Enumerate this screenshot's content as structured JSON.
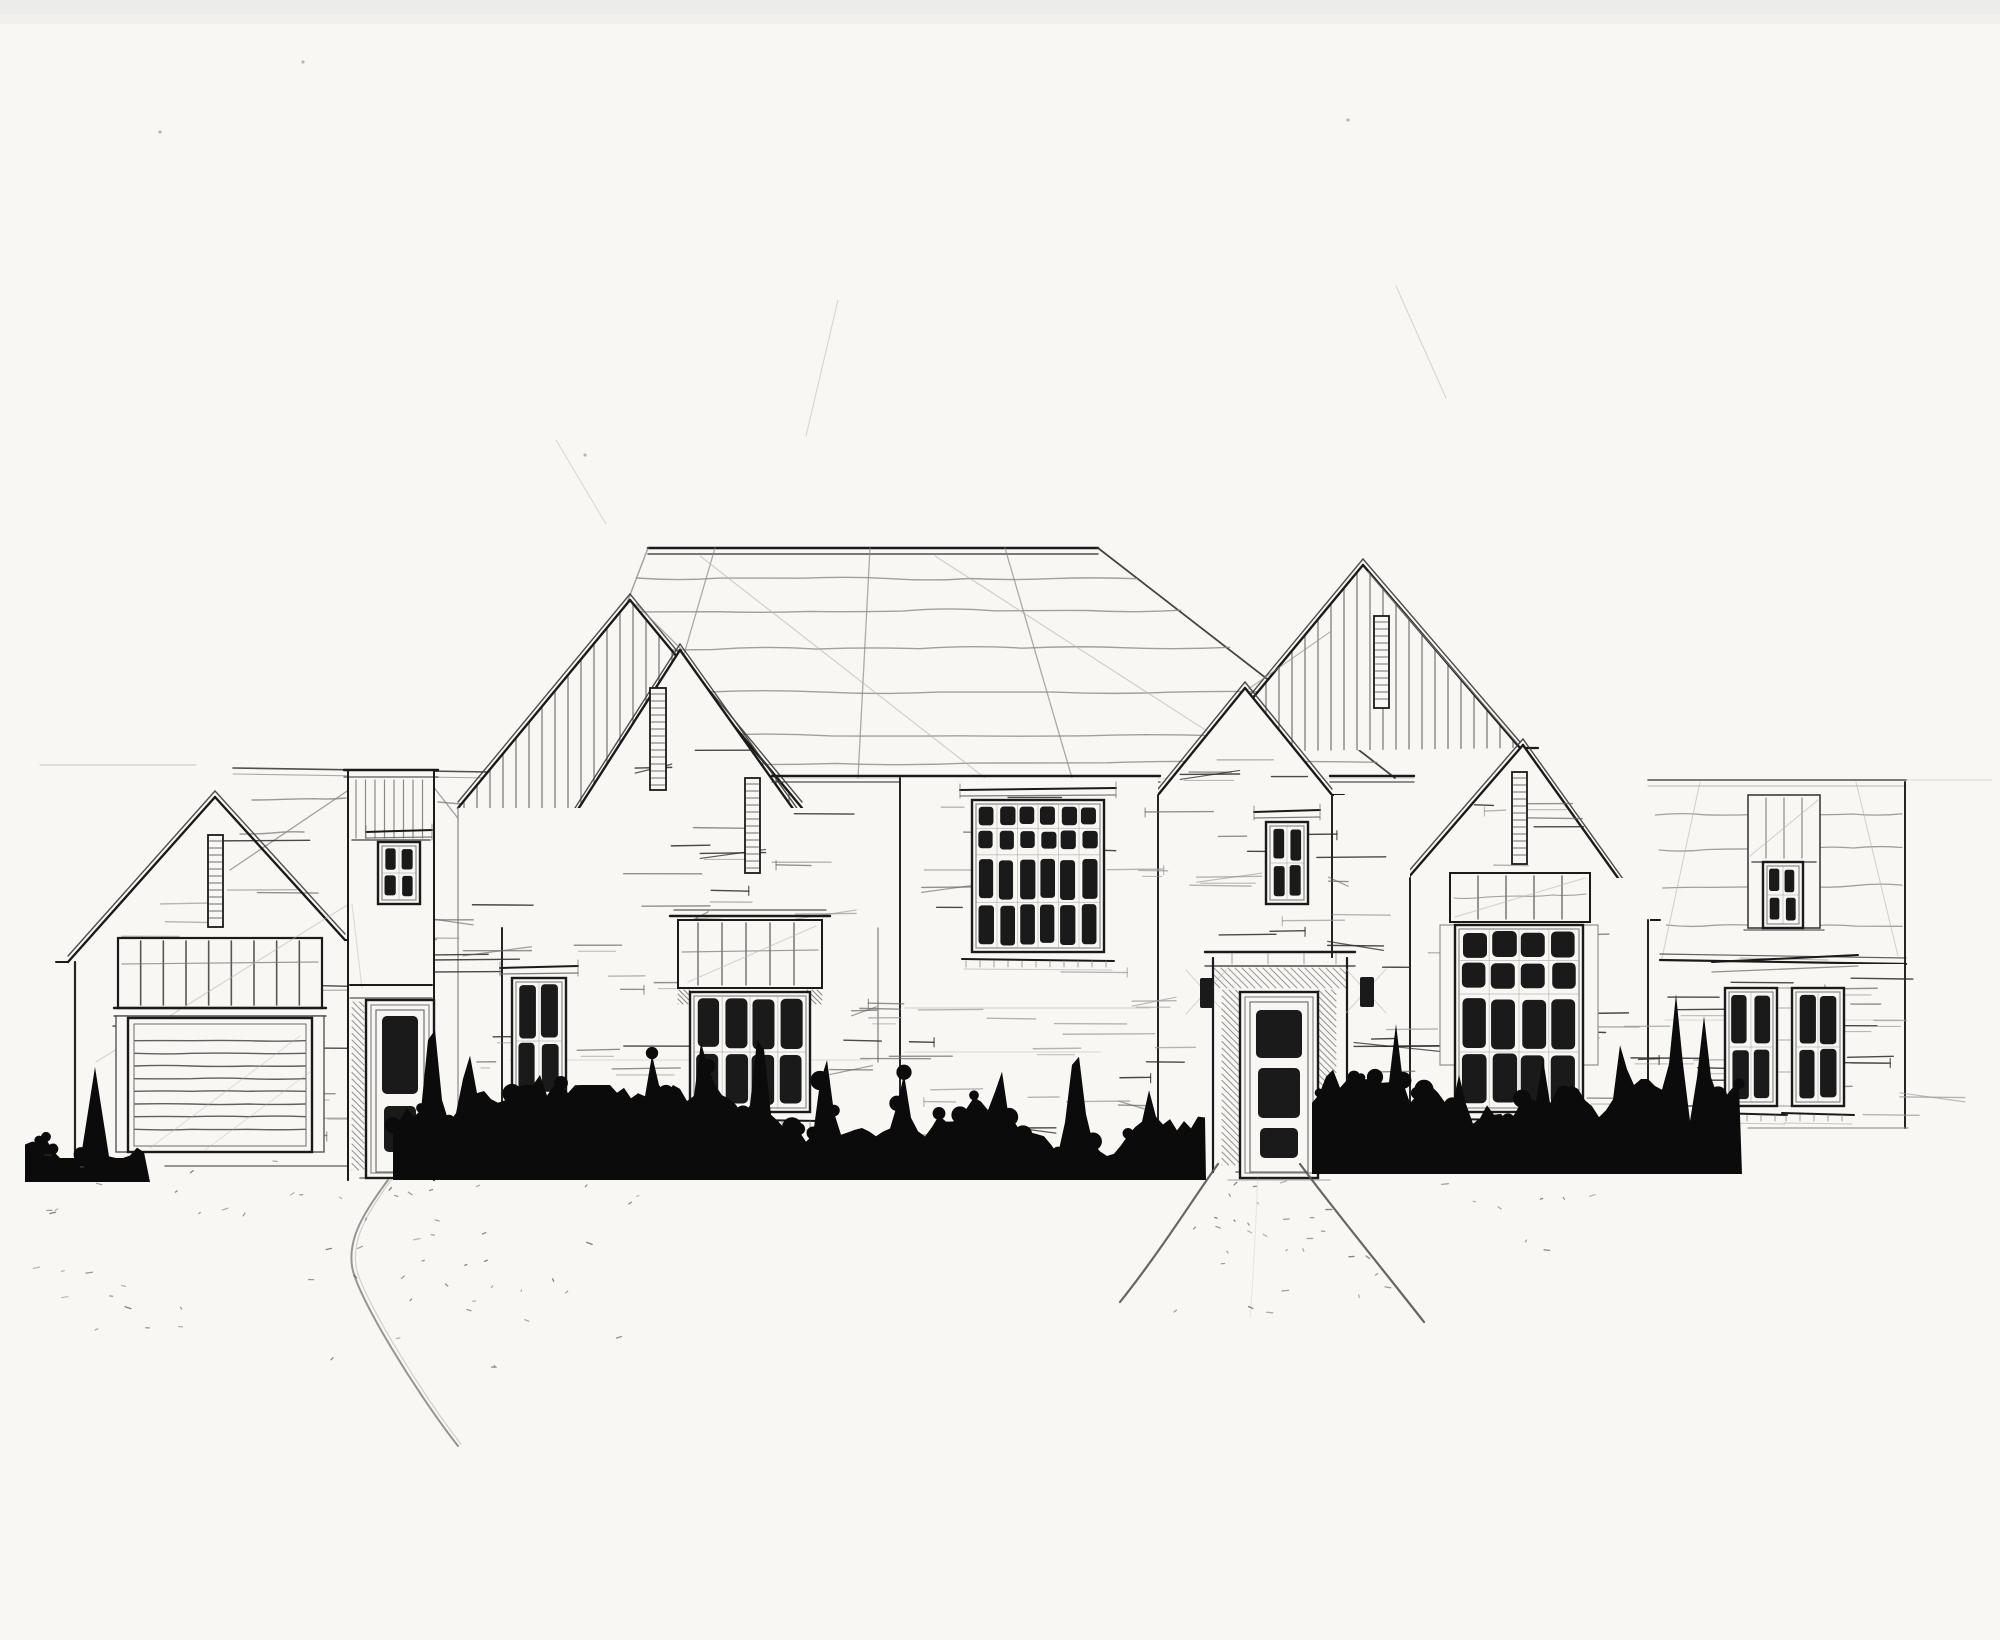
{
  "document": {
    "type": "architectural-sketch",
    "view": "front-elevation",
    "subject": "large single-family residence",
    "medium": "ink and pencil on white paper",
    "aria_label": "Hand-drawn front elevation sketch of a large farmhouse-style residence with gabled roofs, board-and-batten gable faces, brick walls, dark multi-pane windows, a central front door, a two-car garage, an inked shrub hedge along the foundation, a curved driveway and a flared front walk."
  },
  "palette": {
    "paper": "#f8f7f4",
    "ink": "#1a1a1a",
    "ink_soft": "#3c3c3c",
    "pencil": "#8a8a8a",
    "pencil_light": "#b5b5b5",
    "foliage": "#0b0b0b"
  },
  "features": {
    "gables": [
      {
        "name": "garage-gable",
        "siding": "brick"
      },
      {
        "name": "left-back-gable",
        "siding": "board-and-batten"
      },
      {
        "name": "left-front-gable",
        "siding": "brick"
      },
      {
        "name": "front-door-gable",
        "siding": "brick"
      },
      {
        "name": "right-back-gable",
        "siding": "board-and-batten"
      },
      {
        "name": "right-front-gable",
        "siding": "brick"
      }
    ],
    "windows": [
      {
        "name": "tower-window",
        "x": 378,
        "y": 842,
        "w": 42,
        "h": 62,
        "cols": 2,
        "rows": 2,
        "row_heights": [
          0.5,
          0.5
        ],
        "header": true,
        "sill": false
      },
      {
        "name": "left-wall-window",
        "x": 512,
        "y": 978,
        "w": 54,
        "h": 122,
        "cols": 2,
        "rows": 2,
        "row_heights": [
          0.52,
          0.48
        ],
        "header": true,
        "sill": true
      },
      {
        "name": "bay-window",
        "x": 690,
        "y": 992,
        "w": 120,
        "h": 120,
        "cols": 4,
        "rows": 2,
        "row_heights": [
          0.5,
          0.5
        ],
        "header": false,
        "sill": true
      },
      {
        "name": "great-room-window",
        "x": 972,
        "y": 800,
        "w": 132,
        "h": 152,
        "cols": 6,
        "rows": 4,
        "row_heights": [
          0.16,
          0.16,
          0.34,
          0.34
        ],
        "header": true,
        "sill": true
      },
      {
        "name": "door-gable-window",
        "x": 1266,
        "y": 822,
        "w": 42,
        "h": 82,
        "cols": 2,
        "rows": 2,
        "row_heights": [
          0.5,
          0.5
        ],
        "header": true,
        "sill": false
      },
      {
        "name": "right-gable-window",
        "x": 1455,
        "y": 925,
        "w": 128,
        "h": 187,
        "cols": 4,
        "rows": 4,
        "row_heights": [
          0.17,
          0.17,
          0.33,
          0.33
        ],
        "header": false,
        "sill": true
      },
      {
        "name": "right-wing-dormer-window",
        "x": 1763,
        "y": 862,
        "w": 40,
        "h": 66,
        "cols": 2,
        "rows": 2,
        "row_heights": [
          0.5,
          0.5
        ],
        "header": false,
        "sill": false
      },
      {
        "name": "right-wing-window-left",
        "x": 1725,
        "y": 988,
        "w": 52,
        "h": 118,
        "cols": 2,
        "rows": 2,
        "row_heights": [
          0.5,
          0.5
        ],
        "header": false,
        "sill": true
      },
      {
        "name": "right-wing-window-right",
        "x": 1792,
        "y": 988,
        "w": 52,
        "h": 118,
        "cols": 2,
        "rows": 2,
        "row_heights": [
          0.5,
          0.5
        ],
        "header": false,
        "sill": true
      }
    ],
    "vents": [
      {
        "name": "garage-gable-vent",
        "x": 208,
        "y": 835,
        "w": 15,
        "h": 92
      },
      {
        "name": "left-back-gable-vent",
        "x": 650,
        "y": 688,
        "w": 16,
        "h": 102
      },
      {
        "name": "left-front-gable-vent",
        "x": 745,
        "y": 778,
        "w": 15,
        "h": 95
      },
      {
        "name": "right-back-gable-vent",
        "x": 1374,
        "y": 616,
        "w": 15,
        "h": 92
      },
      {
        "name": "right-front-gable-vent",
        "x": 1512,
        "y": 772,
        "w": 15,
        "h": 92
      }
    ],
    "doors": [
      {
        "name": "entry-door",
        "x": 366,
        "y": 1000,
        "w": 68,
        "h": 178,
        "panes": [
          [
            382,
            1016,
            36,
            78
          ],
          [
            384,
            1106,
            32,
            46
          ]
        ]
      },
      {
        "name": "front-door",
        "x": 1240,
        "y": 992,
        "w": 78,
        "h": 186,
        "panes": [
          [
            1256,
            1010,
            46,
            48
          ],
          [
            1258,
            1068,
            42,
            50
          ],
          [
            1260,
            1128,
            38,
            30
          ]
        ]
      }
    ],
    "garage": {
      "door": {
        "x": 128,
        "y": 1018,
        "w": 184,
        "h": 134,
        "slats": 8
      },
      "transom": {
        "x": 118,
        "y": 938,
        "w": 204,
        "h": 70,
        "mullions": 8
      }
    },
    "sconces": [
      {
        "x": 1200,
        "y": 978
      },
      {
        "x": 1360,
        "y": 977
      }
    ],
    "shrub_clusters": [
      {
        "x0": 25,
        "x1": 150,
        "base": 1182,
        "spikes": [
          [
            95,
            115
          ]
        ]
      },
      {
        "x0": 393,
        "x1": 1206,
        "base": 1180,
        "spikes": [
          [
            432,
            180
          ],
          [
            468,
            140
          ],
          [
            540,
            105
          ],
          [
            652,
            125
          ],
          [
            703,
            155
          ],
          [
            760,
            168
          ],
          [
            825,
            135
          ],
          [
            903,
            112
          ],
          [
            1000,
            122
          ],
          [
            1076,
            148
          ],
          [
            1150,
            95
          ]
        ]
      },
      {
        "x0": 1312,
        "x1": 1742,
        "base": 1174,
        "spikes": [
          [
            1330,
            125
          ],
          [
            1396,
            150
          ],
          [
            1460,
            105
          ],
          [
            1543,
            115
          ],
          [
            1622,
            145
          ],
          [
            1676,
            180
          ],
          [
            1704,
            158
          ]
        ]
      }
    ],
    "hardscape": {
      "driveway_curve": true,
      "front_walk": true
    }
  }
}
